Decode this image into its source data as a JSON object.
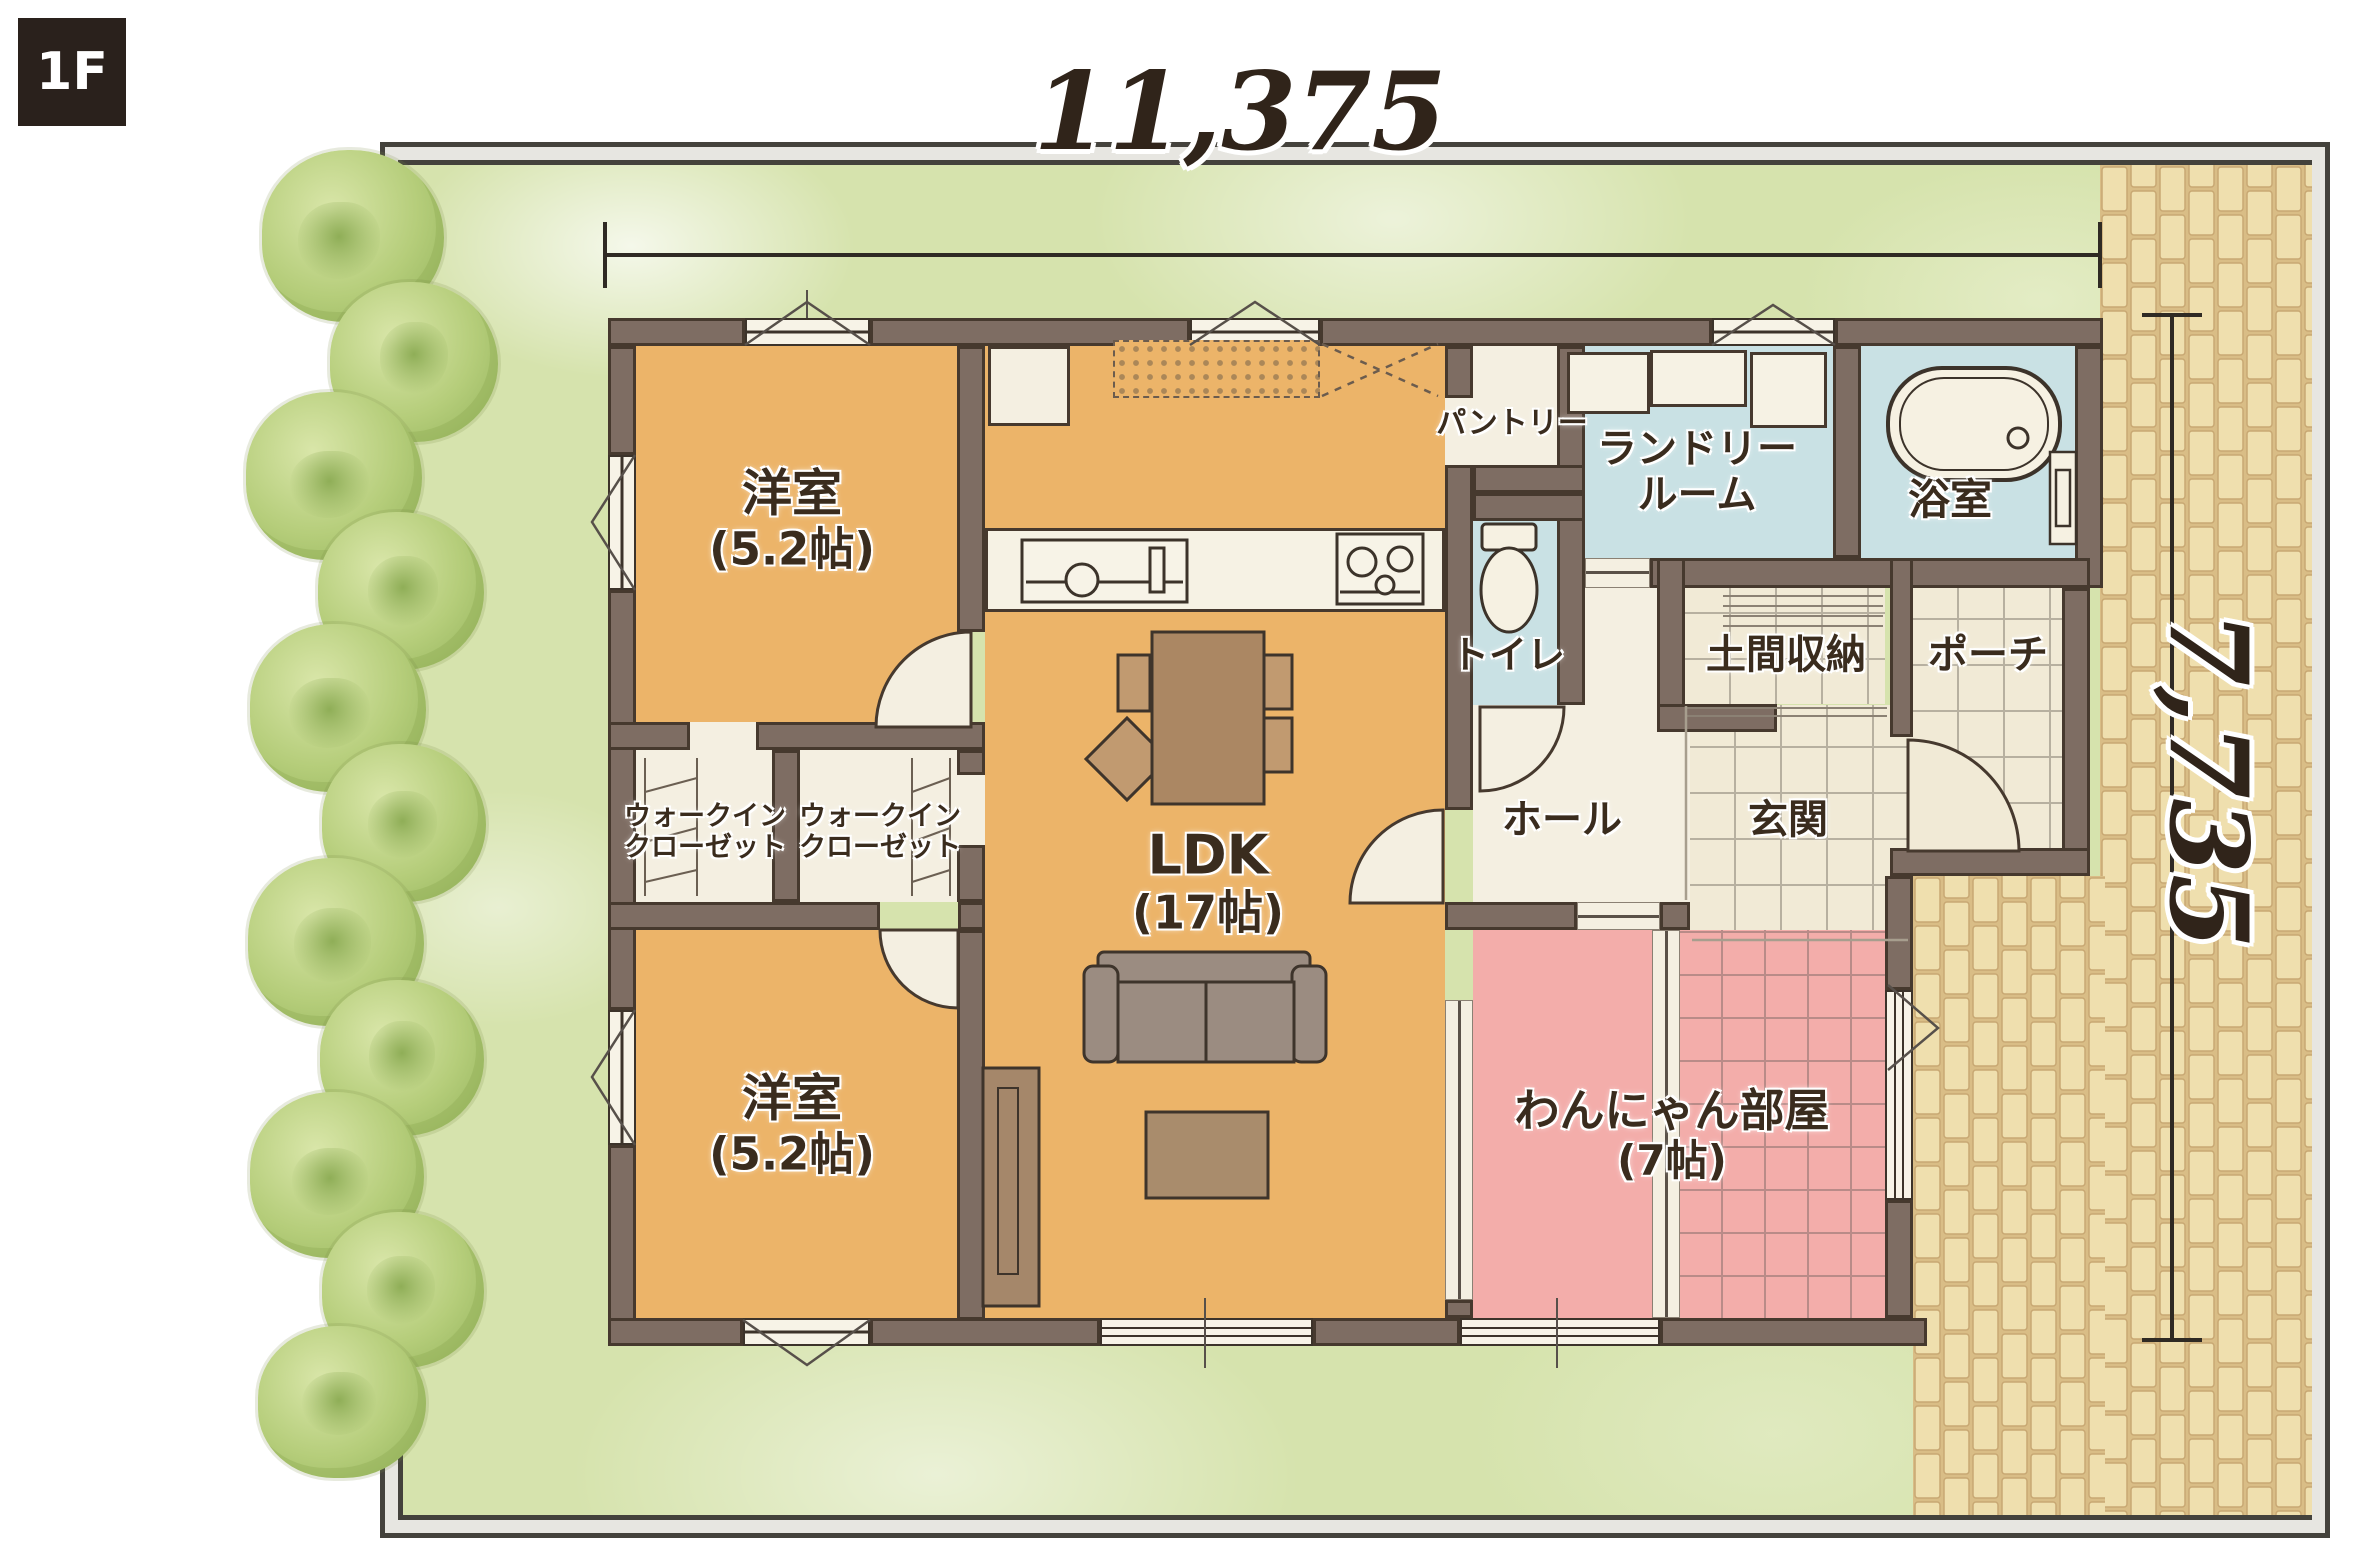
{
  "floor_badge": "1F",
  "dimensions": {
    "width": "11,375",
    "height": "7,735"
  },
  "rooms": {
    "bedroom_top": {
      "name": "洋室",
      "size": "(5.2帖)"
    },
    "bedroom_bottom": {
      "name": "洋室",
      "size": "(5.2帖)"
    },
    "wic_left": {
      "line1": "ウォークイン",
      "line2": "クローゼット"
    },
    "wic_right": {
      "line1": "ウォークイン",
      "line2": "クローゼット"
    },
    "ldk": {
      "name": "LDK",
      "size": "(17帖)"
    },
    "pantry": {
      "name": "パントリー"
    },
    "laundry": {
      "line1": "ランドリー",
      "line2": "ルーム"
    },
    "bath": {
      "name": "浴室"
    },
    "toilet": {
      "name": "トイレ"
    },
    "doma": {
      "name": "土間収納"
    },
    "porch": {
      "name": "ポーチ"
    },
    "genkan": {
      "name": "玄関"
    },
    "hall": {
      "name": "ホール"
    },
    "pet_room": {
      "name": "わんにゃん部屋",
      "size": "(7帖)"
    }
  },
  "colors": {
    "wall": "#7e6d63",
    "room_orange": "#ecb469",
    "room_cream": "#f4efe1",
    "room_blue": "#c9e1e4",
    "room_pink": "#f3adaa",
    "grass": "#d6e3ad",
    "brick": "#efdfae",
    "badge_bg": "#2a211c",
    "text": "#3a2c1e"
  }
}
